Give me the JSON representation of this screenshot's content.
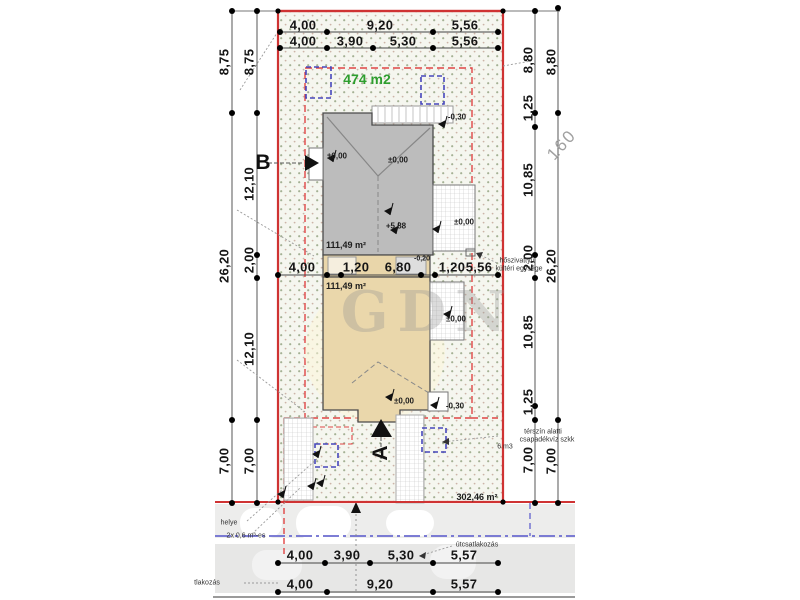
{
  "drawing": {
    "site_area_label": "474 m2",
    "building_area_upper": "111,49 m²",
    "building_area_lower": "111,49 m²",
    "remaining_area": "302,46 m²",
    "parcel_number_partial": "160",
    "watermark": "GDN",
    "sections": {
      "a": "A",
      "b": "B"
    },
    "levels": {
      "zero": "±0,00",
      "ridge": "+5,88",
      "minus30": "-0,30",
      "minus20": "-0,20"
    },
    "annotations": {
      "heat_pump_line1": "hőszivattyú",
      "heat_pump_line2": "kültéri egysége",
      "soakaway_line1": "térszín alatti",
      "soakaway_line2": "csapadékvíz szkk",
      "soakaway_line3": "6 m3",
      "road_connection": "útcsatlakozás",
      "bin_store_line1": "helye",
      "bin_store_line2": "2x 0,6 m³-es",
      "utility_connection": "tlakozás"
    },
    "dimensions": {
      "top_row1": [
        "4,00",
        "9,20",
        "5,56"
      ],
      "top_row2": [
        "4,00",
        "3,90",
        "5,30",
        "5,56"
      ],
      "middle": [
        "4,00",
        "1,20",
        "6,80",
        "1,20",
        "5,56"
      ],
      "bottom_row1": [
        "4,00",
        "3,90",
        "5,30",
        "5,57"
      ],
      "bottom_row2": [
        "4,00",
        "9,20",
        "5,57"
      ],
      "left_outer": [
        "8,75",
        "26,20",
        "7,00"
      ],
      "left_inner": [
        "8,75",
        "12,10",
        "2,00",
        "12,10",
        "7,00"
      ],
      "right_inner": [
        "8,80",
        "1,25",
        "10,85",
        "2,00",
        "10,85",
        "1,25",
        "7,00"
      ],
      "right_outer": [
        "8,80",
        "26,20",
        "7,00"
      ]
    },
    "colors": {
      "boundary_red": "#cf3333",
      "envelope_red": "#e04545",
      "tree_blue": "#4646bb",
      "road_blue": "#6b6bcf",
      "building_gray": "#bcbcbc",
      "building_tan": "#ead7ab",
      "area_green": "#2e9e2e"
    }
  }
}
